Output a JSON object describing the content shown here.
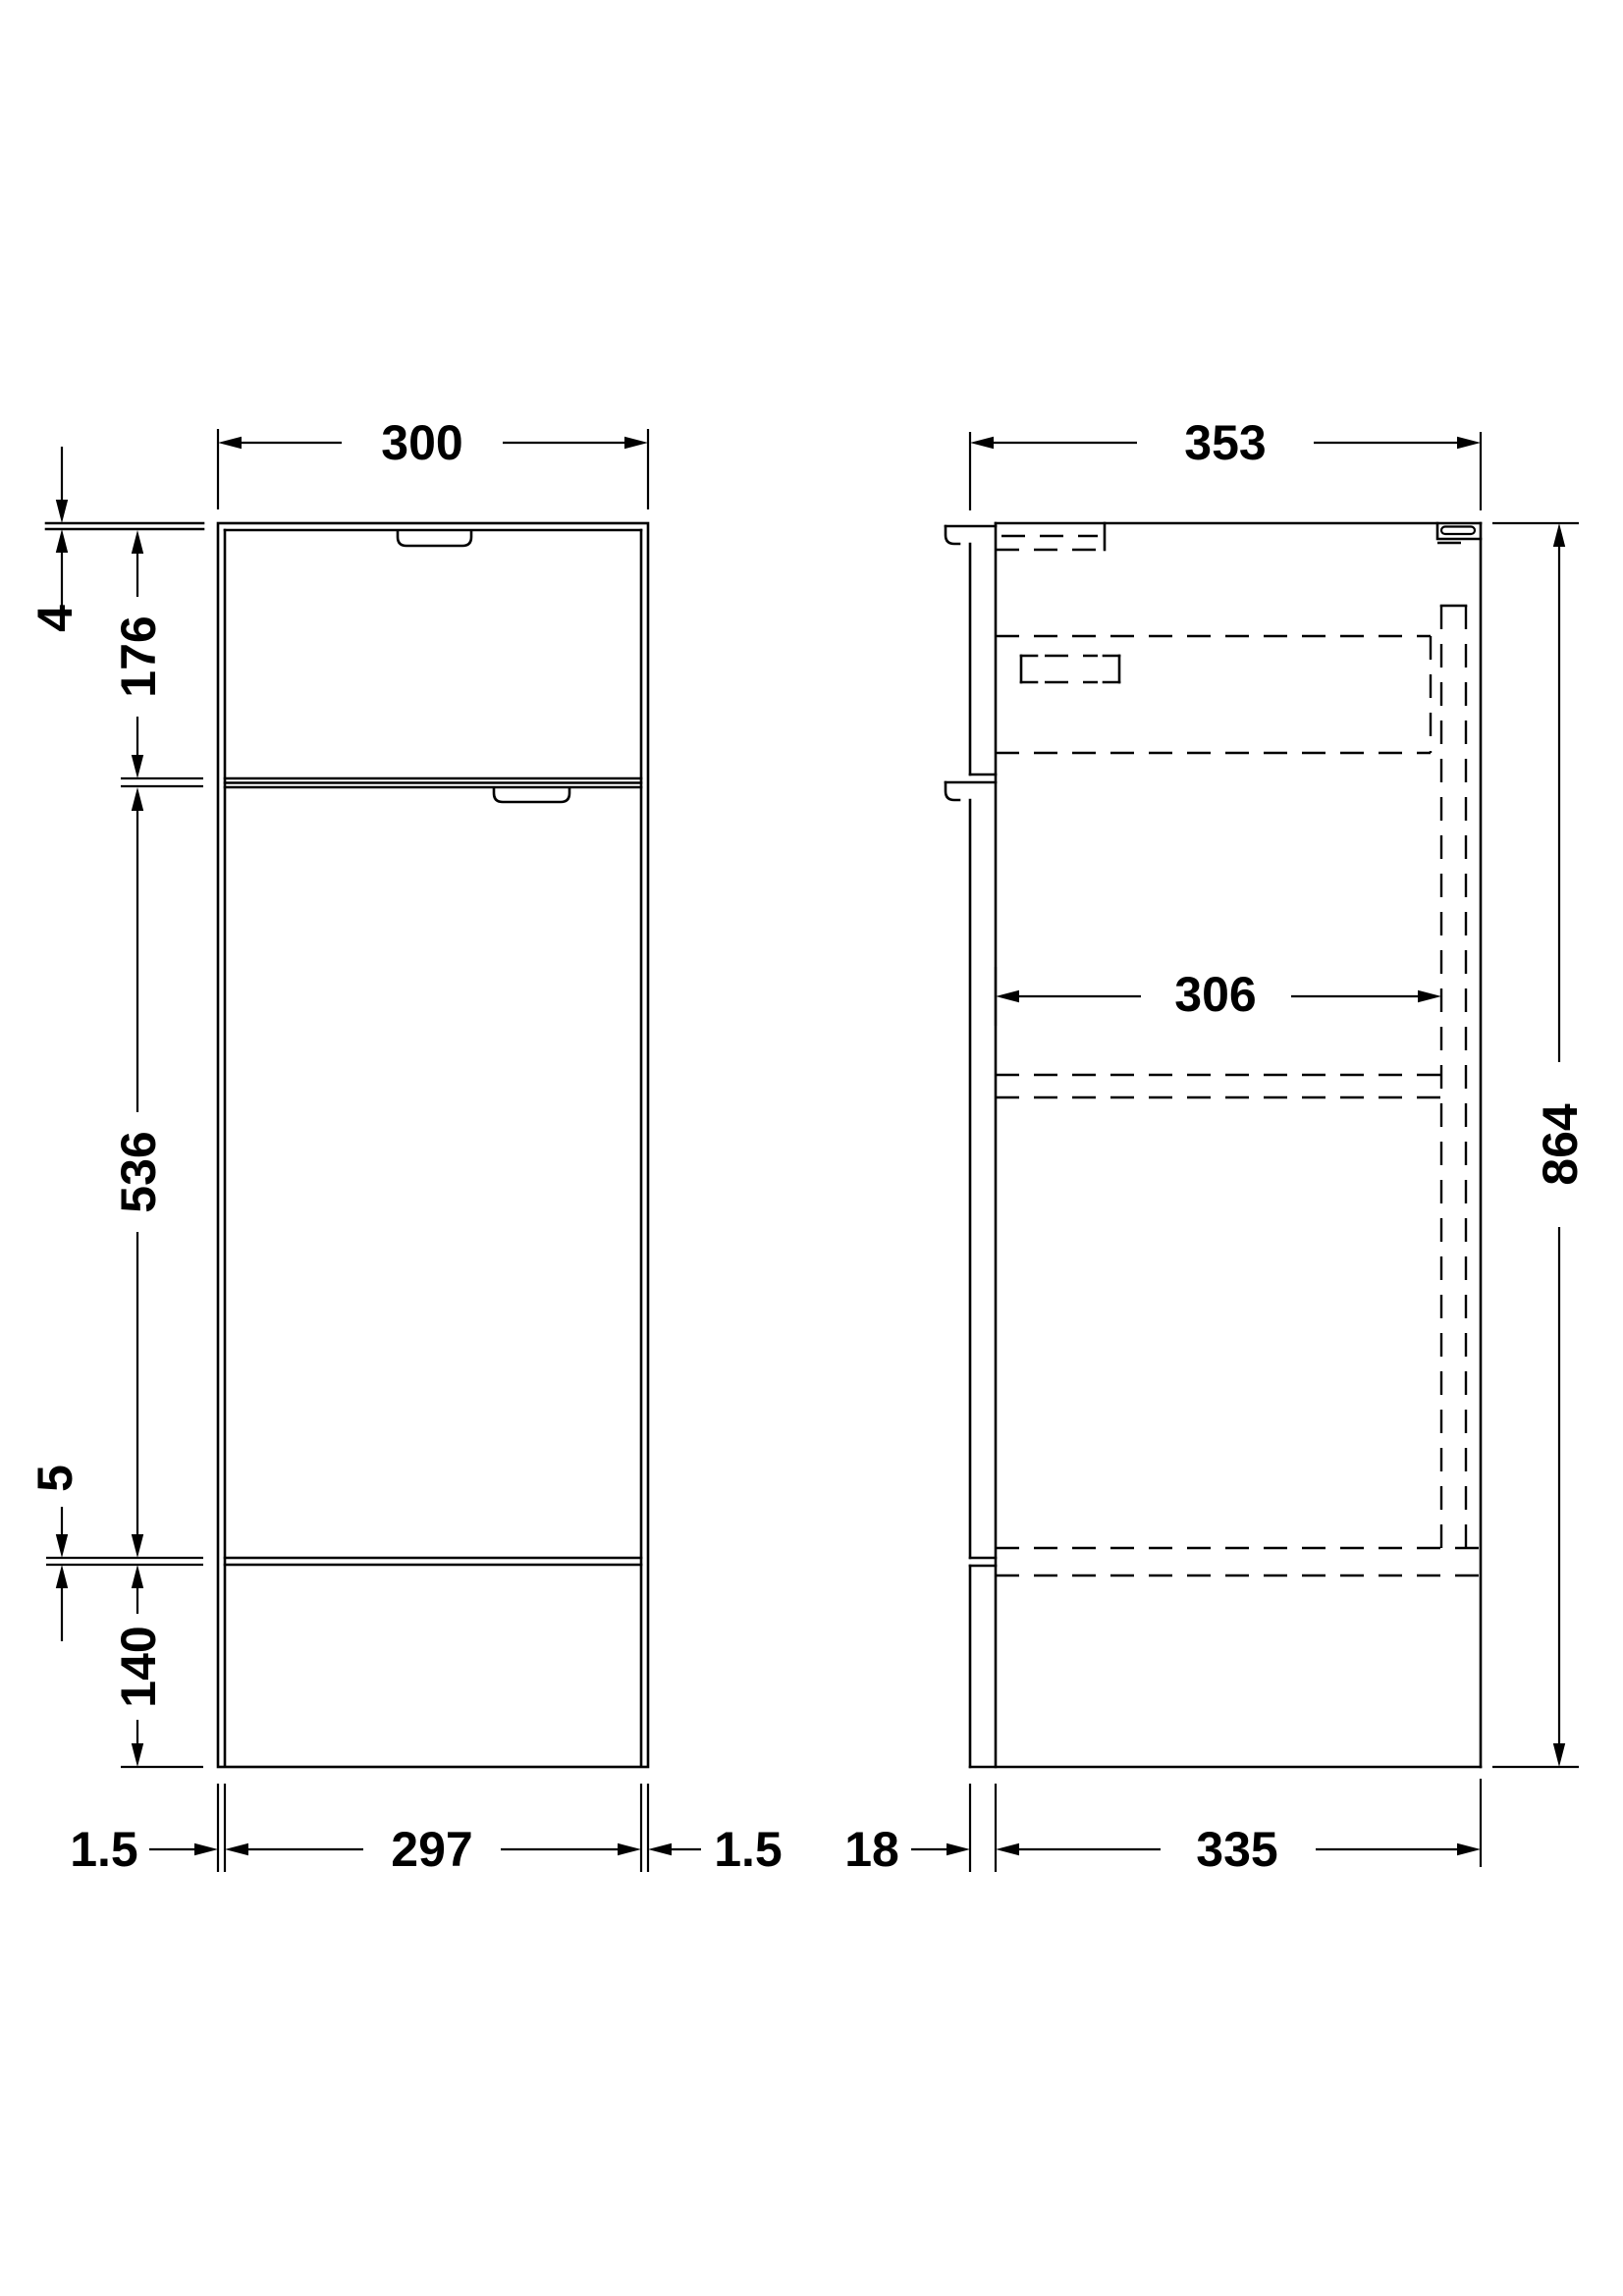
{
  "drawing": {
    "front_view": {
      "dims": {
        "width_top": "300",
        "worktop_thickness": "4",
        "drawer_height": "176",
        "door_height": "536",
        "bottom_gap": "5",
        "plinth_height": "140",
        "left_reveal": "1.5",
        "door_width": "297",
        "right_reveal": "1.5"
      }
    },
    "side_view": {
      "dims": {
        "total_depth": "353",
        "internal_depth": "306",
        "total_height": "864",
        "front_thickness": "18",
        "carcass_depth": "335"
      }
    },
    "colors": {
      "line": "#000000",
      "background": "#ffffff"
    }
  }
}
